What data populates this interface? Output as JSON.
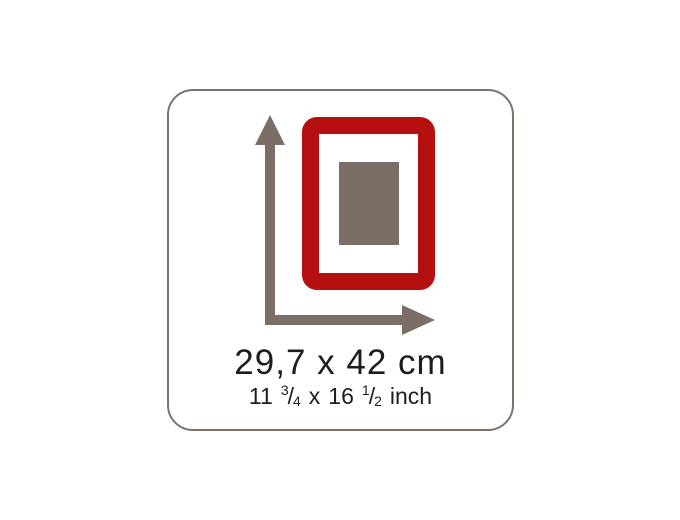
{
  "card": {
    "border_color": "#7c736c",
    "background_color": "#ffffff"
  },
  "diagram": {
    "arrow_color": "#7a6e66",
    "frame_color": "#b50f0f",
    "photo_color": "#7a6e66"
  },
  "labels": {
    "metric": "29,7 x 42 cm",
    "imperial": {
      "first_number": "11",
      "first_fraction_numerator": "3",
      "first_fraction_slash": "/",
      "first_fraction_denominator": "4",
      "multiplier": "x",
      "second_number": "16",
      "second_fraction_numerator": "1",
      "second_fraction_slash": "/",
      "second_fraction_denominator": "2",
      "unit": "inch"
    }
  }
}
